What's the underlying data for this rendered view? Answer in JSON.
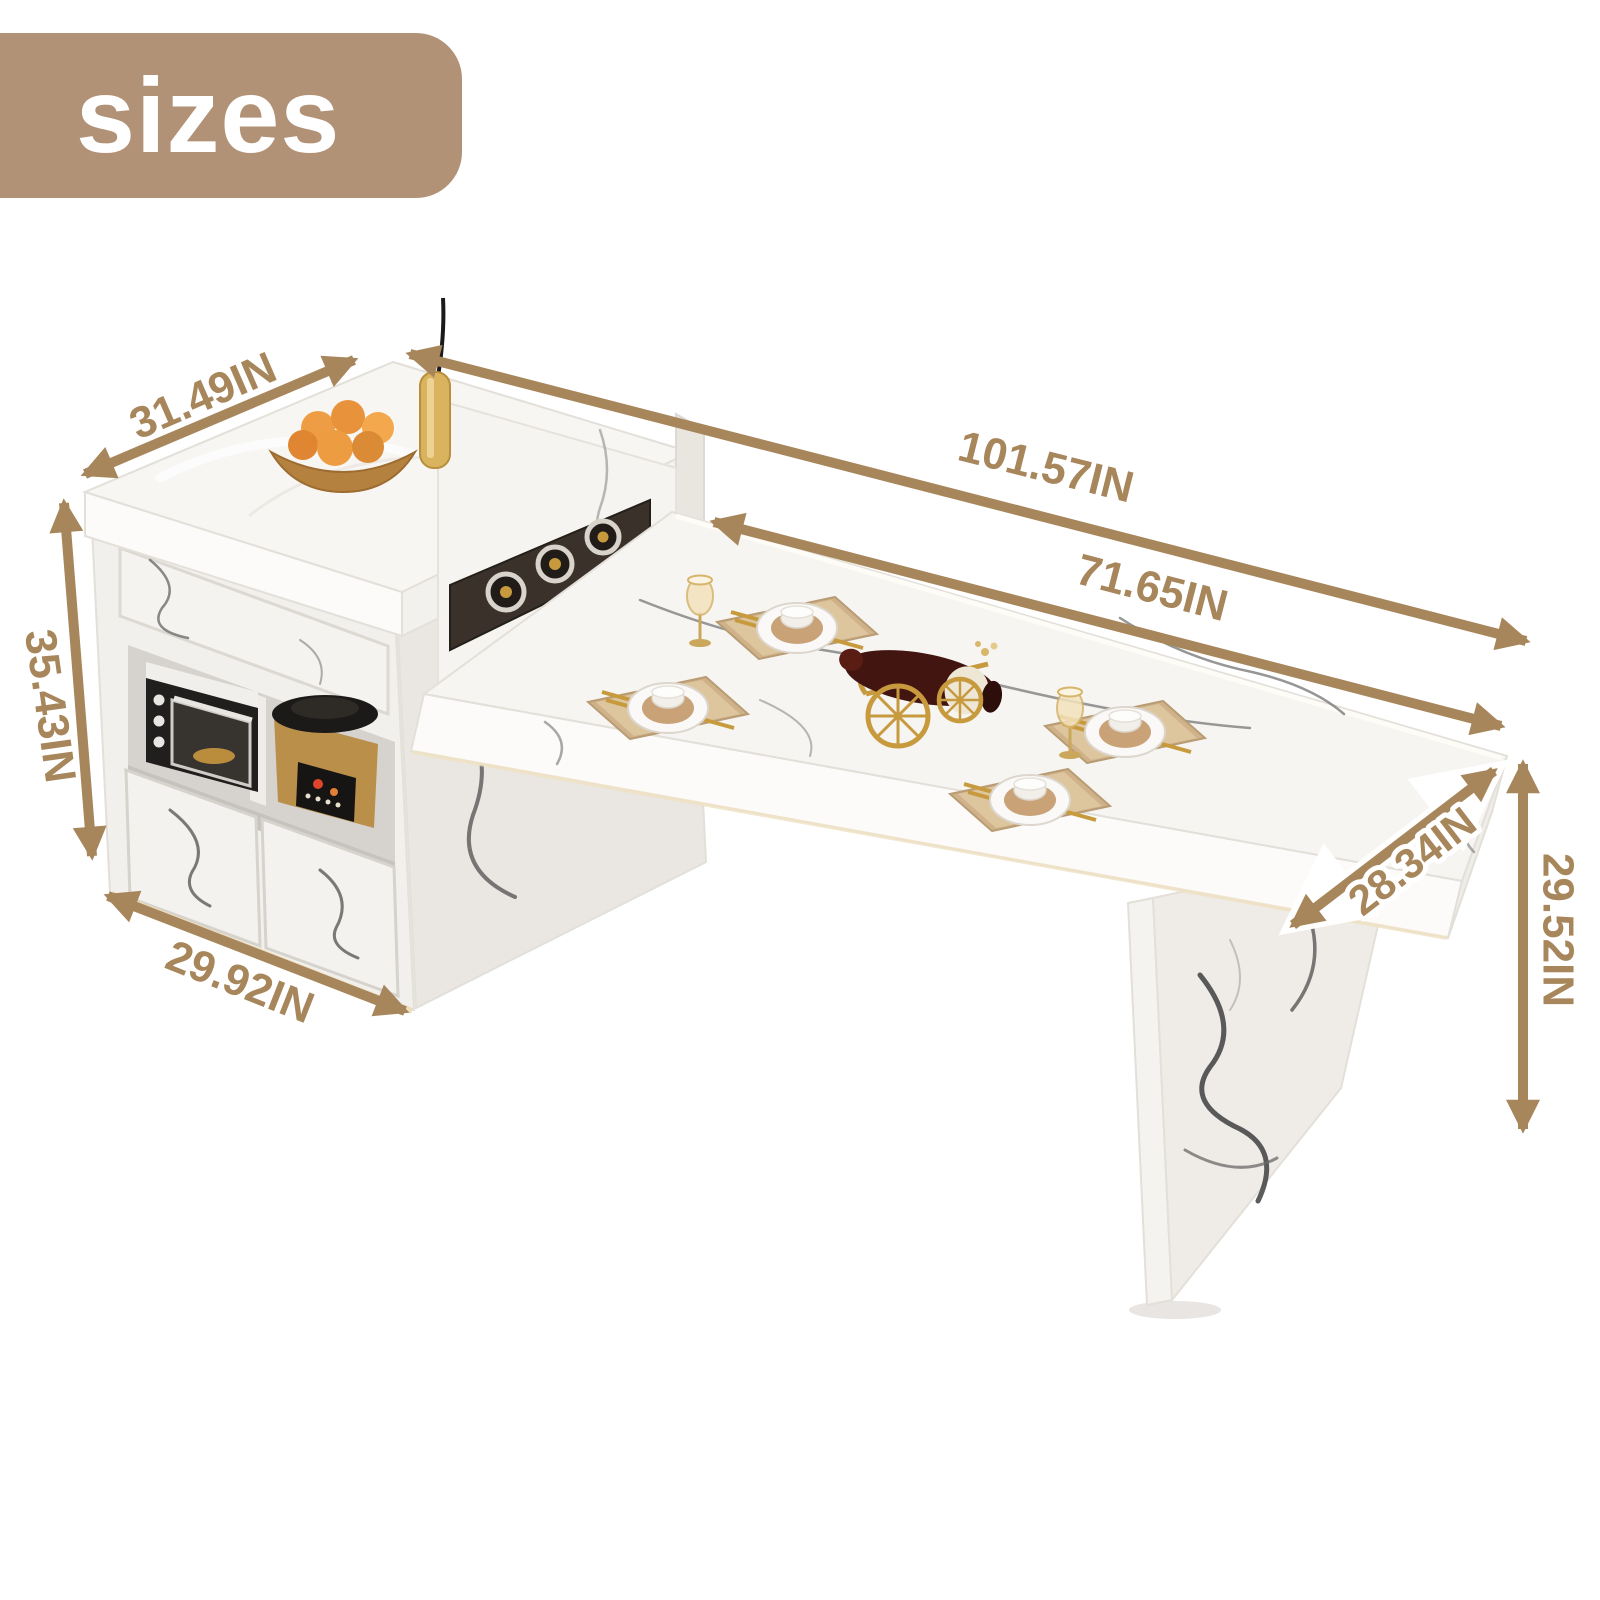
{
  "badge": {
    "label": "sizes"
  },
  "colors": {
    "badge_bg": "#b29277",
    "badge_text": "#ffffff",
    "dimension_tan": "#a8865c",
    "label_outline": "#ffffff",
    "background": "#ffffff",
    "marble_white": "#f7f5f2",
    "marble_vein": "#4f4f4f",
    "gold_accent": "#c79a3e",
    "appliance_dark": "#211f1e"
  },
  "dimensions": {
    "island_top_depth": "31.49IN",
    "overall_length": "101.57IN",
    "tabletop_length": "71.65IN",
    "island_height": "35.43IN",
    "island_width": "29.92IN",
    "table_depth": "28.34IN",
    "table_height": "29.52IN"
  }
}
